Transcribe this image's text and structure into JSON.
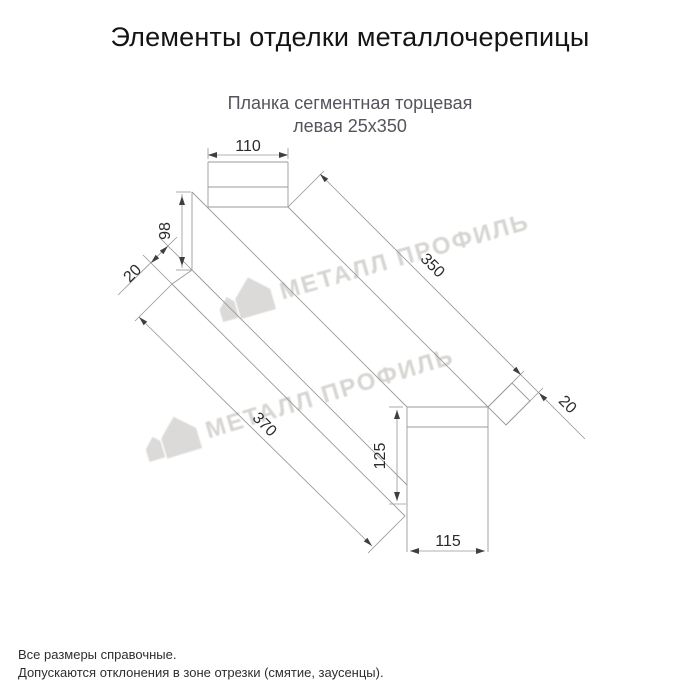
{
  "header": {
    "title": "Элементы отделки металлочерепицы"
  },
  "product": {
    "subtitle_line1": "Планка сегментная торцевая",
    "subtitle_line2": "левая 25х350"
  },
  "drawing": {
    "type": "technical-diagram",
    "part": "Планка сегментная торцевая левая 25х350",
    "dimensions": {
      "top_width": "110",
      "left_edge_height": "98",
      "left_hem": "20",
      "upper_length": "350",
      "right_hem": "20",
      "lower_length": "370",
      "right_height": "125",
      "bottom_width": "115"
    }
  },
  "watermark": {
    "text": "МЕТАЛЛ ПРОФИЛЬ"
  },
  "footer": {
    "note1": "Все размеры справочные.",
    "note2": "Допускаются отклонения в зоне отрезки (смятие, заусенцы)."
  },
  "colors": {
    "background": "#ffffff",
    "title": "#141414",
    "subtitle": "#54545c",
    "drawing_line": "#9a9a9a",
    "dimension_text": "#2b2b2b",
    "arrow": "#3f3f3f",
    "watermark": "#d7d5d2"
  }
}
